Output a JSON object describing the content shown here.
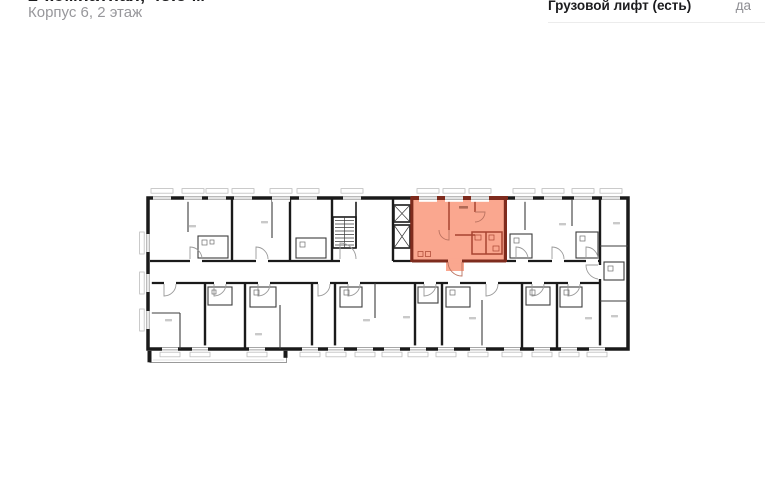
{
  "header": {
    "title": "2-комнатная, 43.5 м²",
    "subtitle": "Корпус 6, 2 этаж"
  },
  "specs": {
    "rows": [
      {
        "label": "Грузовой лифт (есть)",
        "value": "да"
      }
    ]
  },
  "plan": {
    "description": "floor-plan",
    "colors": {
      "wall": "#1a1a1a",
      "thin": "#3c3c3c",
      "hl-fill": "#FAA78F",
      "hl-wall-dark": "#7E2B1D",
      "hl-wall": "#A84430",
      "win": "#8f8f8f",
      "sill": "#bdbdbd",
      "label": "#c9c9c9",
      "arc": "#9a9a9a"
    }
  }
}
